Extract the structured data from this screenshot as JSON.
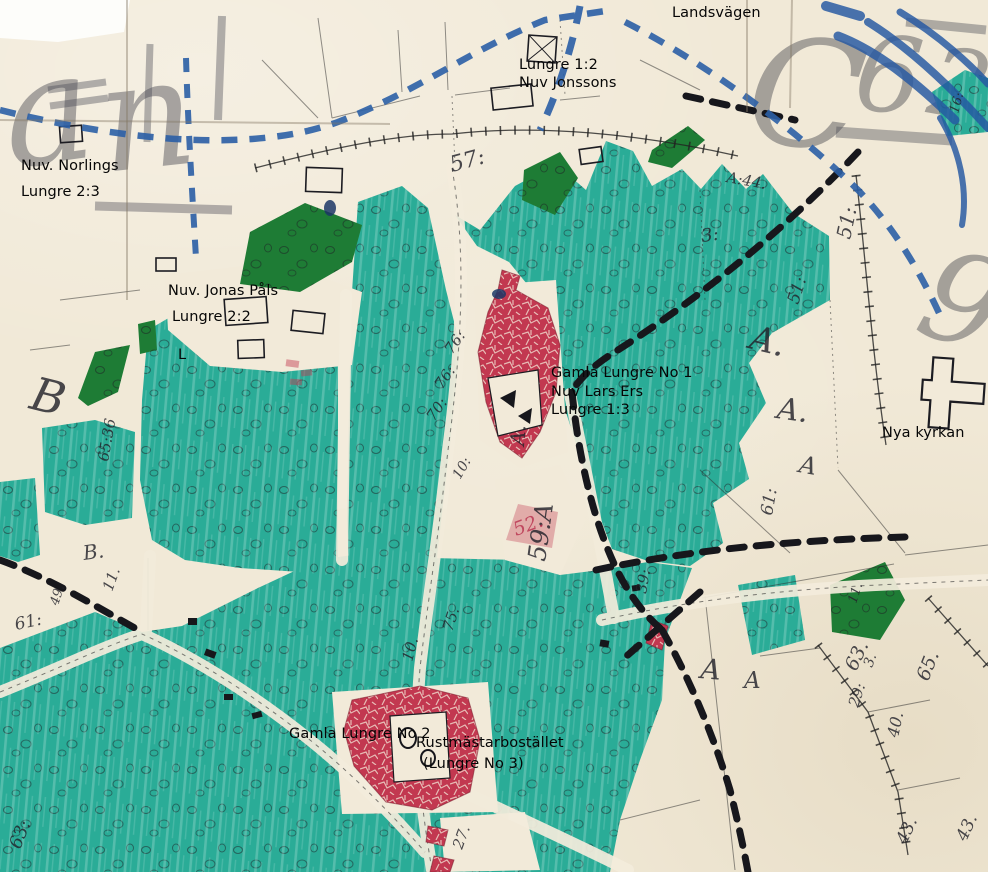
{
  "colors": {
    "paper": "#f1e9d7",
    "field_teal": "#2aac97",
    "forest_green": "#1e7c35",
    "building_red": "#c23850",
    "road_blue": "#2b5fa6",
    "ink_black": "#17171c"
  },
  "labels": {
    "landsvagen": "Landsvägen",
    "jonssons_1": "Lungre 1:2",
    "jonssons_2": "Nuv Jonssons",
    "norlings_1": "Nuv. Norlings",
    "norlings_2": "Lungre 2:3",
    "jonas_pals_1": "Nuv. Jonas Påls",
    "jonas_pals_2": "Lungre 2:2",
    "l_mark": "L",
    "lars_ers_1": "Gamla Lungre No 1",
    "lars_ers_2": "Nuv Lars Ers",
    "lars_ers_3": "Lungre 1:3",
    "nya_kyrkan": "Nya kyrkan",
    "gamla_no2": "Gamla Lungre No 2",
    "rustmastar_1": "Rustmästarbostället",
    "rustmastar_2": "(Lungre No 3)"
  },
  "map_numbers": {
    "n57": "57:",
    "a44": "A:44.",
    "n3": "3:",
    "n51a": "51:",
    "n51b": "51:",
    "aBig1": "A.",
    "aBig2": "A.",
    "aBig3": "A",
    "aBig4": "A",
    "aBig5": "A",
    "aV": "A.",
    "n61a": "61:",
    "n59a": "59:A",
    "n52": "52.",
    "n76a": "76:",
    "n76b": "76:",
    "n70": "70:",
    "n75": "75.",
    "n10a": "10.",
    "n10b": "10:",
    "n39": "39:",
    "n63a": "63.",
    "n65a": "65.",
    "n3b": "3.",
    "n29": "29:",
    "n40": "40.",
    "n43a": "43.",
    "n43b": "43.",
    "n6536": "65:36",
    "bBig": "B",
    "bDot": "B.",
    "n11a": "11.",
    "n61b": "61:",
    "n49": "49.",
    "n11b": "11.",
    "n16": "16:",
    "n27": "27.",
    "n63b": "63:"
  },
  "background_letters": {
    "ga": "a",
    "gn": "n",
    "gC": "C",
    "g6": "6",
    "g2": "2",
    "g9": "9"
  }
}
